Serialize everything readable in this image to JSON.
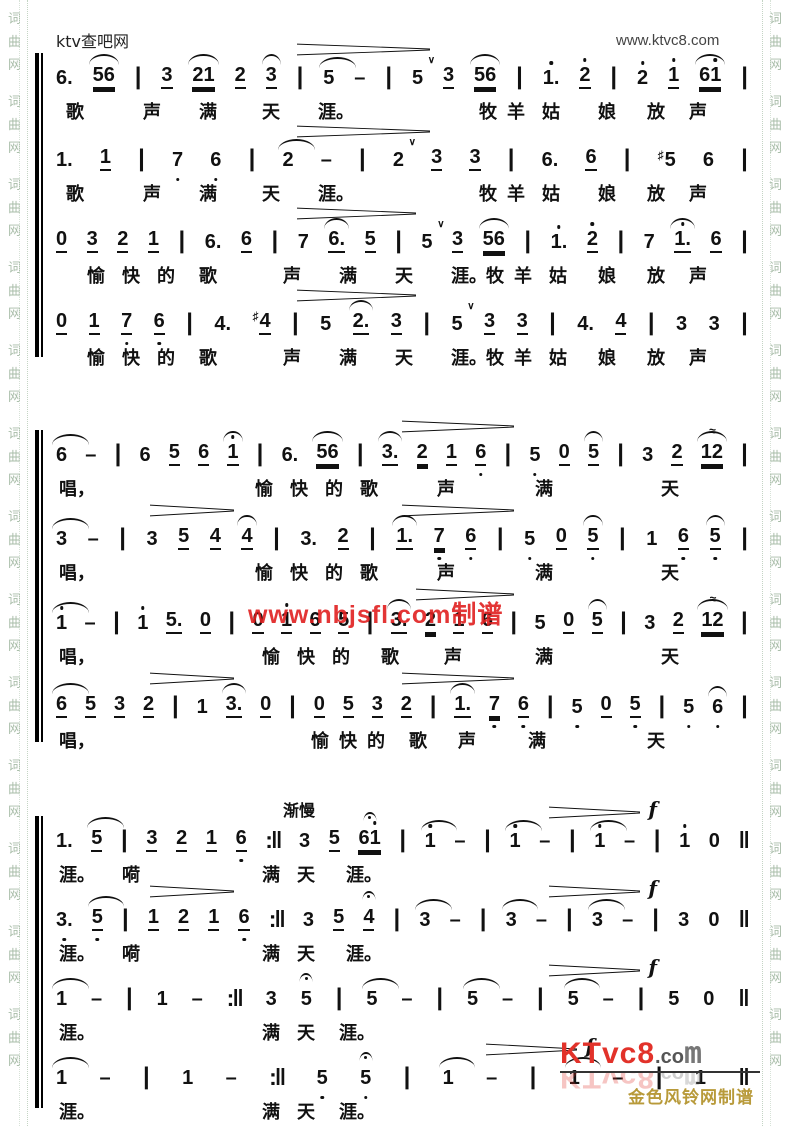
{
  "page": {
    "site_label": "ktv查吧网",
    "site_url": "www.ktvc8.com",
    "watermark": "www.nbjsfl.com制谱",
    "tempo_mark": "渐慢",
    "forte_mark": "f",
    "logo": {
      "brand_red": "KTvc8",
      "brand_dot": ".co",
      "brand_m": "m",
      "credit": "金色风铃网制谱"
    },
    "border_chars": [
      "词",
      "曲",
      "网"
    ],
    "colors": {
      "accent_red": "#e02020",
      "logo_red": "#e2322a",
      "gold": "#b89a3a",
      "border_green": "#a9bda9"
    }
  },
  "systems": [
    {
      "voices": [
        {
          "music": [
            "6.",
            "56:u2,arc",
            "|",
            "3:u1",
            "21:u2,arc",
            "2:u1",
            "3:u1,arc",
            "|",
            "5:arcw",
            "-",
            "|",
            "5:v",
            "3:u1",
            "56:u2,arc",
            "|",
            "1.:da",
            "2:da,u1",
            "|",
            "2:da",
            "1:da,u1",
            "61:u2,arc,dar",
            "|"
          ],
          "lyrics": [
            [
              "歌",
              2
            ],
            [
              "声",
              13
            ],
            [
              "满",
              21
            ],
            [
              "天",
              30
            ],
            [
              "涯。",
              38
            ],
            [
              "牧",
              61
            ],
            [
              "羊",
              65
            ],
            [
              "姑",
              70
            ],
            [
              "娘",
              78
            ],
            [
              "放",
              85
            ],
            [
              "声",
              91
            ]
          ],
          "dyn": [
            {
              "l": 35,
              "w": 19
            }
          ]
        },
        {
          "music": [
            "1.",
            "1:u1",
            "|",
            "7:db",
            "6:db",
            "|",
            "2:arcw",
            "-",
            "|",
            "2:v",
            "3:u1",
            "3:u1",
            "|",
            "6.",
            "6:u1",
            "|",
            "5:sh",
            "6",
            "|"
          ],
          "lyrics": [
            [
              "歌",
              2
            ],
            [
              "声",
              13
            ],
            [
              "满",
              21
            ],
            [
              "天",
              30
            ],
            [
              "涯。",
              38
            ],
            [
              "牧",
              61
            ],
            [
              "羊",
              65
            ],
            [
              "姑",
              70
            ],
            [
              "娘",
              78
            ],
            [
              "放",
              85
            ],
            [
              "声",
              91
            ]
          ],
          "dyn": [
            {
              "l": 35,
              "w": 19
            }
          ]
        },
        {
          "music": [
            "0:u1",
            "3:u1",
            "2:u1",
            "1:u1",
            "|",
            "6.",
            "6:u1",
            "|",
            "7",
            "6.:u1,arc",
            "5:u1",
            "|",
            "5:v",
            "3:u1",
            "56:u2,arc",
            "|",
            "1.:da",
            "2:da,u1",
            "|",
            "7",
            "1.:da,u1,arc",
            "6:u1",
            "|"
          ],
          "lyrics": [
            [
              "愉",
              5
            ],
            [
              "快",
              10
            ],
            [
              "的",
              15
            ],
            [
              "歌",
              21
            ],
            [
              "声",
              33
            ],
            [
              "满",
              41
            ],
            [
              "天",
              49
            ],
            [
              "涯。",
              57
            ],
            [
              "牧",
              62
            ],
            [
              "羊",
              66
            ],
            [
              "姑",
              71
            ],
            [
              "娘",
              78
            ],
            [
              "放",
              85
            ],
            [
              "声",
              91
            ]
          ],
          "dyn": [
            {
              "l": 35,
              "w": 17
            }
          ]
        },
        {
          "music": [
            "0:u1",
            "1:u1",
            "7:db,u1",
            "6:db,u1",
            "|",
            "4.",
            "4:sh,u1",
            "|",
            "5",
            "2.:u1,arc",
            "3:u1",
            "|",
            "5:v",
            "3:u1",
            "3:u1",
            "|",
            "4.",
            "4:u1",
            "|",
            "3",
            "3",
            "|"
          ],
          "lyrics": [
            [
              "愉",
              5
            ],
            [
              "快",
              10
            ],
            [
              "的",
              15
            ],
            [
              "歌",
              21
            ],
            [
              "声",
              33
            ],
            [
              "满",
              41
            ],
            [
              "天",
              49
            ],
            [
              "涯。",
              57
            ],
            [
              "牧",
              62
            ],
            [
              "羊",
              66
            ],
            [
              "姑",
              71
            ],
            [
              "娘",
              78
            ],
            [
              "放",
              85
            ],
            [
              "声",
              91
            ]
          ],
          "dyn": [
            {
              "l": 35,
              "w": 17
            }
          ]
        }
      ]
    },
    {
      "voices": [
        {
          "music": [
            "6:arcw",
            "-",
            "|",
            "6",
            "5:u1",
            "6:u1",
            "1:da,u1,arc",
            "|",
            "6.",
            "56:u2,arc",
            "|",
            "3.:u1,arc",
            "2:u2",
            "1:u1",
            "6:db,u1",
            "|",
            "5:db",
            "0:u1",
            "5:u1,arc",
            "|",
            "3",
            "2:u1",
            "12:u2,arc,tr",
            "|"
          ],
          "lyrics": [
            [
              "唱，",
              1
            ],
            [
              "愉",
              29
            ],
            [
              "快",
              34
            ],
            [
              "的",
              39
            ],
            [
              "歌",
              44
            ],
            [
              "声",
              55
            ],
            [
              "满",
              69
            ],
            [
              "天",
              87
            ]
          ],
          "dyn": [
            {
              "l": 50,
              "w": 16
            }
          ]
        },
        {
          "music": [
            "3:arcw",
            "-",
            "|",
            "3",
            "5:u1",
            "4:u1",
            "4:u1,arc",
            "|",
            "3.",
            "2:u1",
            "|",
            "1.:u1,arc",
            "7:db,u2",
            "6:db,u1",
            "|",
            "5:db",
            "0:u1",
            "5:db,u1,arc",
            "|",
            "1",
            "6:db,u1",
            "5:db,u1,arc",
            "|"
          ],
          "lyrics": [
            [
              "唱，",
              1
            ],
            [
              "愉",
              29
            ],
            [
              "快",
              34
            ],
            [
              "的",
              39
            ],
            [
              "歌",
              44
            ],
            [
              "声",
              55
            ],
            [
              "满",
              69
            ],
            [
              "天",
              87
            ]
          ],
          "dyn": [
            {
              "l": 14,
              "w": 12
            },
            {
              "l": 50,
              "w": 16
            }
          ]
        },
        {
          "music": [
            "1:da,arcw",
            "-",
            "|",
            "1:da",
            "5.:u1",
            "0:u1",
            "|",
            "0:u1",
            "1:da,u1",
            "6:u1",
            "5:u1",
            "|",
            "3.:u1,arc",
            "2:u2",
            "1:u1",
            "6:u1",
            "|",
            "5",
            "0:u1",
            "5:u1,arc",
            "|",
            "3",
            "2:u1",
            "12:u2,arc,tr",
            "|"
          ],
          "lyrics": [
            [
              "唱，",
              1
            ],
            [
              "愉",
              30
            ],
            [
              "快",
              35
            ],
            [
              "的",
              40
            ],
            [
              "歌",
              47
            ],
            [
              "声",
              56
            ],
            [
              "满",
              69
            ],
            [
              "天",
              87
            ]
          ],
          "dyn": [
            {
              "l": 52,
              "w": 14
            }
          ]
        },
        {
          "music": [
            "6:u1,arcw",
            "5:u1",
            "3:u1",
            "2:u1",
            "|",
            "1",
            "3.:u1,arc",
            "0:u1",
            "|",
            "0:u1",
            "5:u1",
            "3:u1",
            "2:u1",
            "|",
            "1.:u1,arc",
            "7:db,u2",
            "6:db,u1",
            "|",
            "5:db",
            "0:u1",
            "5:db,u1",
            "|",
            "5:db",
            "6:db,arc",
            "|"
          ],
          "lyrics": [
            [
              "唱，",
              1
            ],
            [
              "愉",
              37
            ],
            [
              "快",
              41
            ],
            [
              "的",
              45
            ],
            [
              "歌",
              51
            ],
            [
              "声",
              58
            ],
            [
              "满",
              68
            ],
            [
              "天",
              85
            ]
          ],
          "dyn": [
            {
              "l": 14,
              "w": 12
            },
            {
              "l": 50,
              "w": 16
            }
          ]
        }
      ]
    },
    {
      "voices": [
        {
          "music": [
            "1.",
            "5:u1,arcw",
            "|",
            "3:u1",
            "2:u1",
            "1:u1",
            "6:db,u1",
            "R",
            "3",
            "5:u1",
            "61:u2,dar,fer",
            "|",
            "1:da,arcw",
            "-",
            "|",
            "1:da,arcw",
            "-",
            "|",
            "1:da,arcw",
            "-",
            "|",
            "1:da",
            "0",
            "F"
          ],
          "lyrics": [
            [
              "涯。",
              1
            ],
            [
              "嗬",
              10
            ],
            [
              "满",
              30
            ],
            [
              "天",
              35
            ],
            [
              "涯。",
              42
            ]
          ],
          "dyn": [
            {
              "l": 71,
              "w": 13,
              "f": true
            }
          ]
        },
        {
          "music": [
            "3.:db",
            "5:db,u1,arcw",
            "|",
            "1:u1",
            "2:u1",
            "1:u1",
            "6:db,u1",
            "R",
            "3",
            "5:u1",
            "4:u1,fer",
            "|",
            "3:arcw",
            "-",
            "|",
            "3:arcw",
            "-",
            "|",
            "3:arcw",
            "-",
            "|",
            "3",
            "0",
            "F"
          ],
          "lyrics": [
            [
              "涯。",
              1
            ],
            [
              "嗬",
              10
            ],
            [
              "满",
              30
            ],
            [
              "天",
              35
            ],
            [
              "涯。",
              42
            ]
          ],
          "dyn": [
            {
              "l": 14,
              "w": 12
            },
            {
              "l": 71,
              "w": 13,
              "f": true
            }
          ]
        },
        {
          "music": [
            "1:arcw",
            "-",
            "|",
            "1",
            "-",
            "R",
            "3",
            "5:fer",
            "|",
            "5:arcw",
            "-",
            "|",
            "5:arcw",
            "-",
            "|",
            "5:arcw",
            "-",
            "|",
            "5",
            "0",
            "F"
          ],
          "lyrics": [
            [
              "涯。",
              1
            ],
            [
              "满",
              30
            ],
            [
              "天",
              35
            ],
            [
              "涯。",
              41
            ]
          ],
          "dyn": [
            {
              "l": 71,
              "w": 13,
              "f": true
            }
          ]
        },
        {
          "music": [
            "1:arcw",
            "-",
            "|",
            "1",
            "-",
            "R",
            "5:db",
            "5:db,fer",
            "|",
            "1:arcw",
            "-",
            "|",
            "1:arcw",
            "-",
            "|",
            "1",
            "F"
          ],
          "lyrics": [
            [
              "涯。",
              1
            ],
            [
              "满",
              30
            ],
            [
              "天",
              35
            ],
            [
              "涯。",
              41
            ]
          ],
          "dyn": [
            {
              "l": 62,
              "w": 13,
              "f": true
            }
          ]
        }
      ]
    }
  ]
}
